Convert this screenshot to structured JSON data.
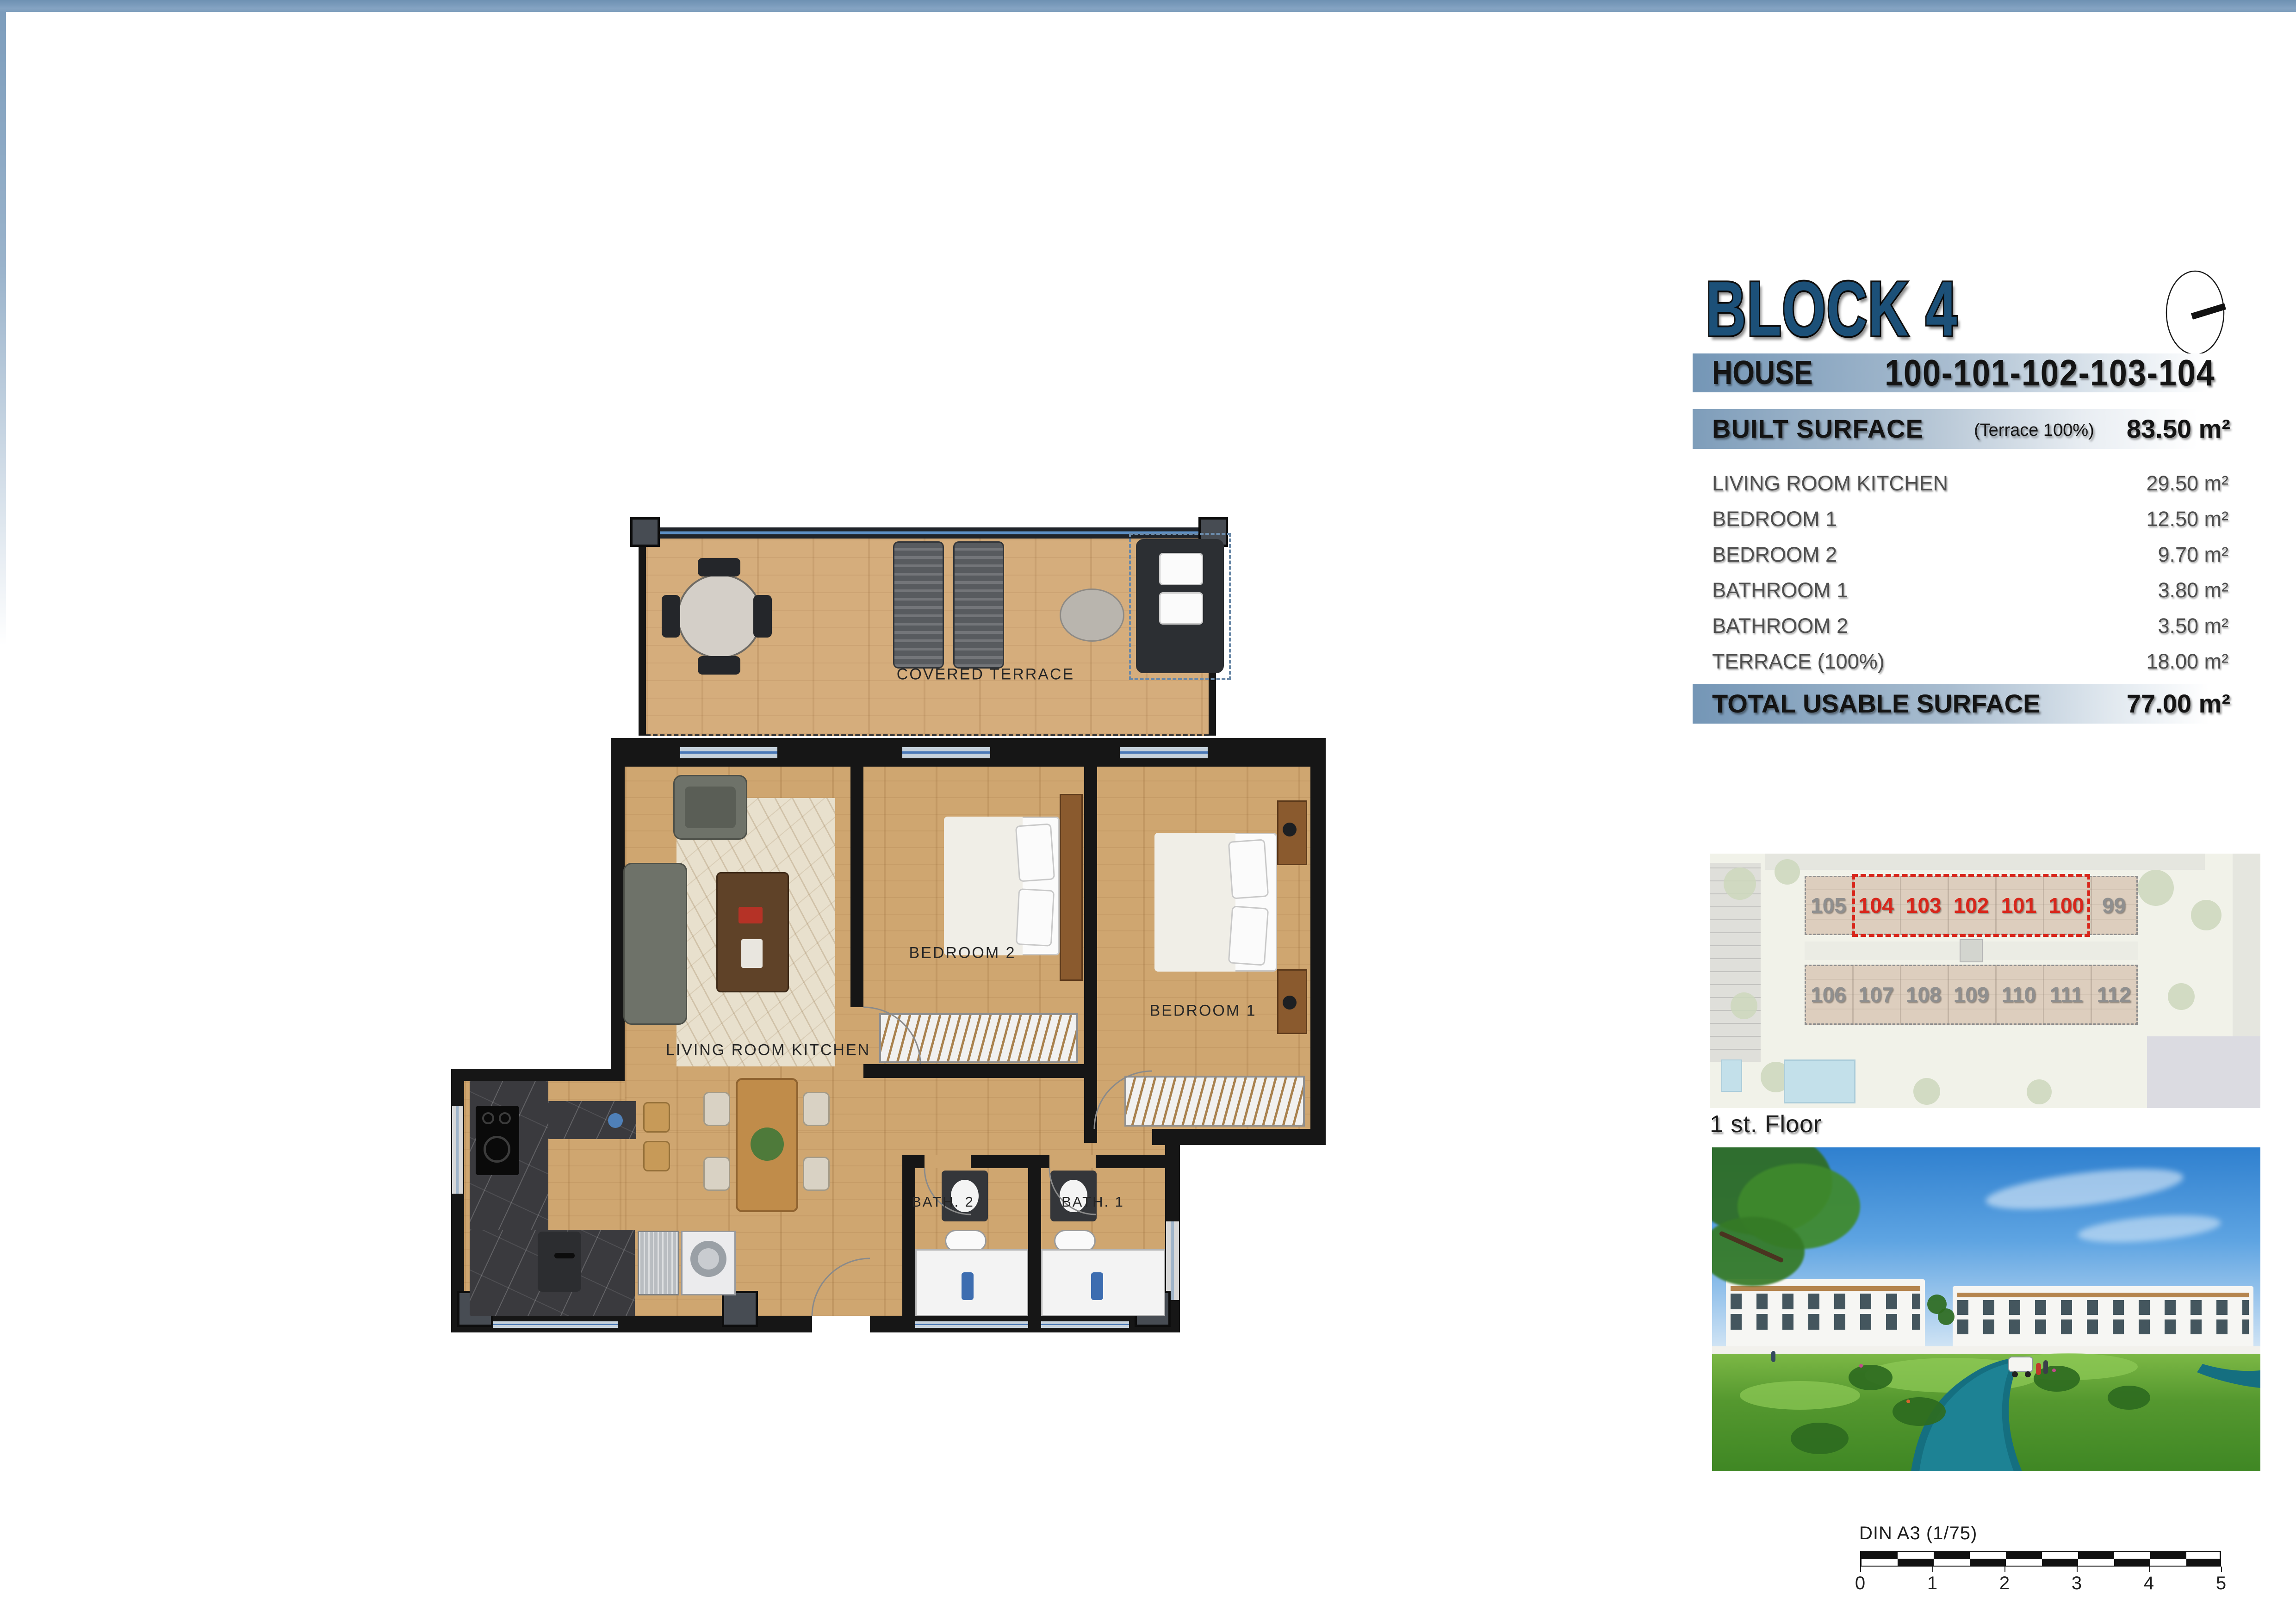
{
  "header": {
    "block_title": "BLOCK 4",
    "accent_color": "#1c5078"
  },
  "info_panel": {
    "house_label": "HOUSE",
    "house_numbers": "100-101-102-103-104",
    "built_surface_label": "BUILT SURFACE",
    "built_surface_note": "(Terrace 100%)",
    "built_surface_value": "83.50 m²",
    "rooms": [
      {
        "name": "LIVING ROOM KITCHEN",
        "area": "29.50 m²"
      },
      {
        "name": "BEDROOM 1",
        "area": "12.50 m²"
      },
      {
        "name": "BEDROOM 2",
        "area": "9.70 m²"
      },
      {
        "name": "BATHROOM 1",
        "area": "3.80 m²"
      },
      {
        "name": "BATHROOM 2",
        "area": "3.50 m²"
      },
      {
        "name": "TERRACE (100%)",
        "area": "18.00 m²"
      }
    ],
    "total_label": "TOTAL USABLE SURFACE",
    "total_value": "77.00 m²"
  },
  "floor_plan": {
    "labels": {
      "covered_terrace": "COVERED TERRACE",
      "living_room": "LIVING ROOM KITCHEN",
      "bedroom_1": "BEDROOM 1",
      "bedroom_2": "BEDROOM 2",
      "bath_1": "BATH. 1",
      "bath_2": "BATH. 2"
    }
  },
  "site_plan": {
    "floor_label": "1 st. Floor",
    "top_row_units": [
      "105",
      "104",
      "103",
      "102",
      "101",
      "100",
      "99"
    ],
    "bottom_row_units": [
      "106",
      "107",
      "108",
      "109",
      "110",
      "111",
      "112"
    ],
    "highlighted_units": [
      "104",
      "103",
      "102",
      "101",
      "100"
    ],
    "highlight_color": "#d8261b",
    "unit_color": "#8f8f8f"
  },
  "scale_bar": {
    "label": "DIN A3 (1/75)",
    "ticks": [
      "0",
      "1",
      "2",
      "3",
      "4",
      "5"
    ]
  }
}
